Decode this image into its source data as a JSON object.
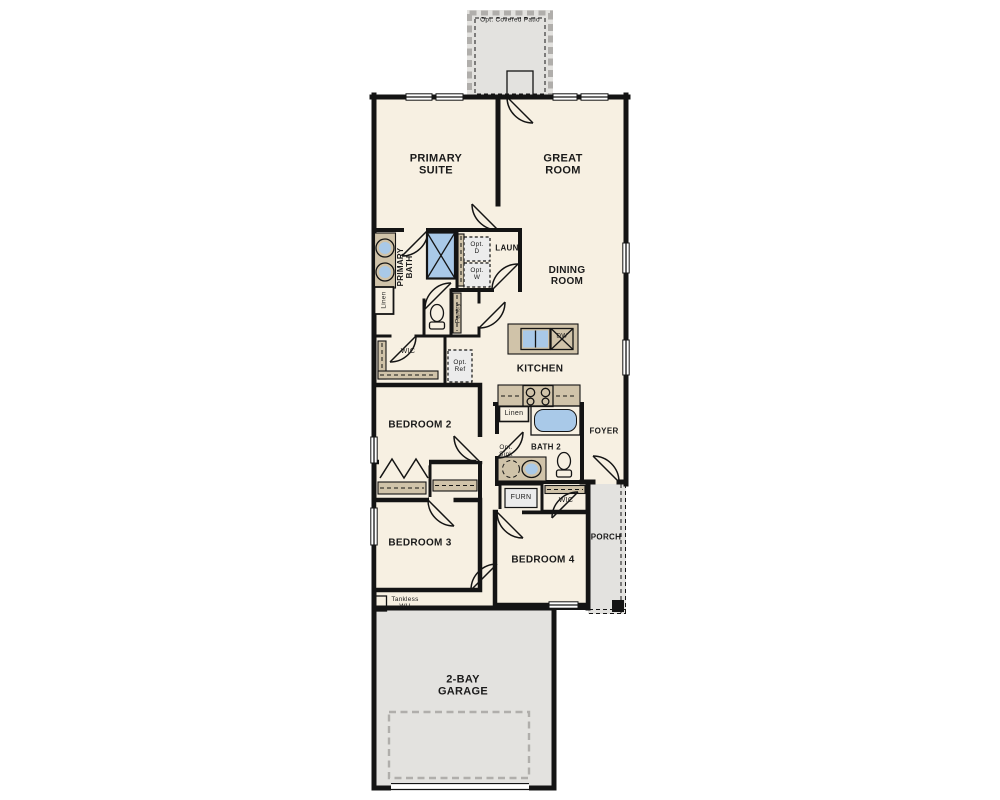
{
  "colors": {
    "floor": "#f7f0e2",
    "outdoor": "#e3e2df",
    "counter": "#d0c3a9",
    "fixture": "#a9c9e8",
    "wall": "#141414",
    "optbox": "#ececec",
    "dashgray": "#b0aeab",
    "text": "#1a1a1a"
  },
  "labels": {
    "patio": "Opt. Covered Patio",
    "primary_suite": "PRIMARY SUITE",
    "great_room": "GREAT ROOM",
    "primary_bath": "PRIMARY BATH",
    "laundry": "LAUN",
    "opt_dryer": "Opt. D",
    "opt_washer": "Opt. W",
    "linen_primary": "Linen",
    "pantry": "Pantry",
    "dining_room": "DINING ROOM",
    "wic_primary": "WIC",
    "opt_ref": "Opt. Ref",
    "kitchen": "KITCHEN",
    "dishwasher": "DW",
    "linen_bath2": "Linen",
    "bedroom2": "BEDROOM 2",
    "bath2": "BATH 2",
    "opt_sink": "Opt. Sink",
    "foyer": "FOYER",
    "furnace": "FURN",
    "wic_bedroom4": "WIC",
    "bedroom3": "BEDROOM 3",
    "bedroom4": "BEDROOM 4",
    "porch": "PORCH",
    "tankless_wh": "Tankless WH",
    "garage": "2-BAY GARAGE"
  }
}
